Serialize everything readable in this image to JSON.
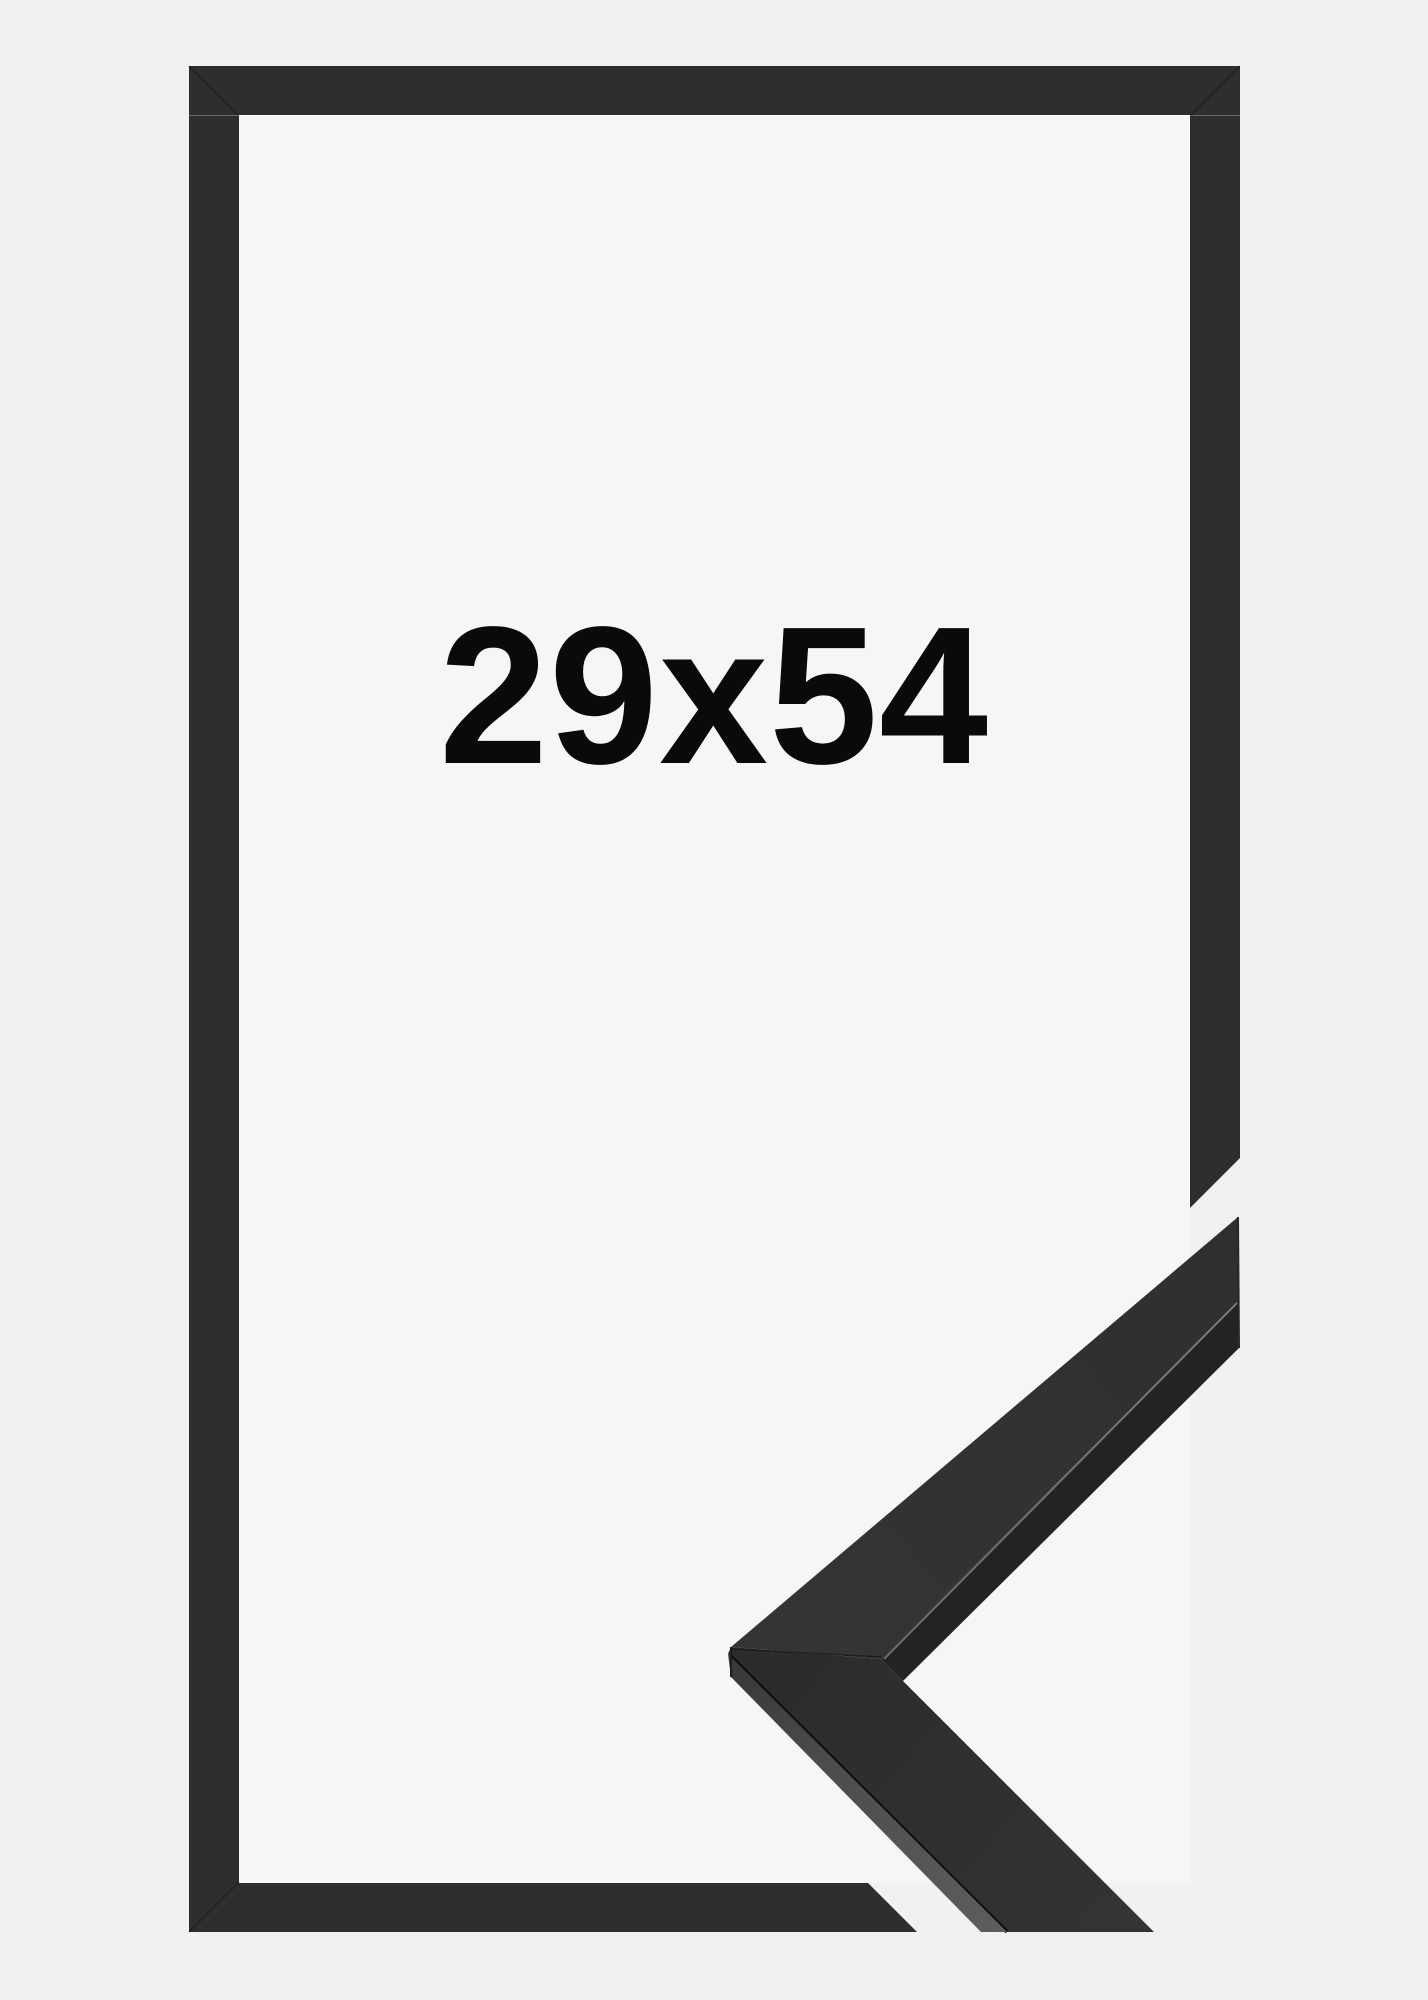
{
  "product_image": {
    "size_label": "29x54",
    "description": "black picture frame, front view with corner profile detail",
    "colors": {
      "background": "#f1f1f2",
      "backing_inner": "#f6f6f6",
      "frame_front": "#2e2e30",
      "moulding_top_face": "#333335",
      "moulding_side_light": "#5a5a5c",
      "moulding_side_dark": "#232325",
      "label_text": "#0a0a0a"
    }
  }
}
